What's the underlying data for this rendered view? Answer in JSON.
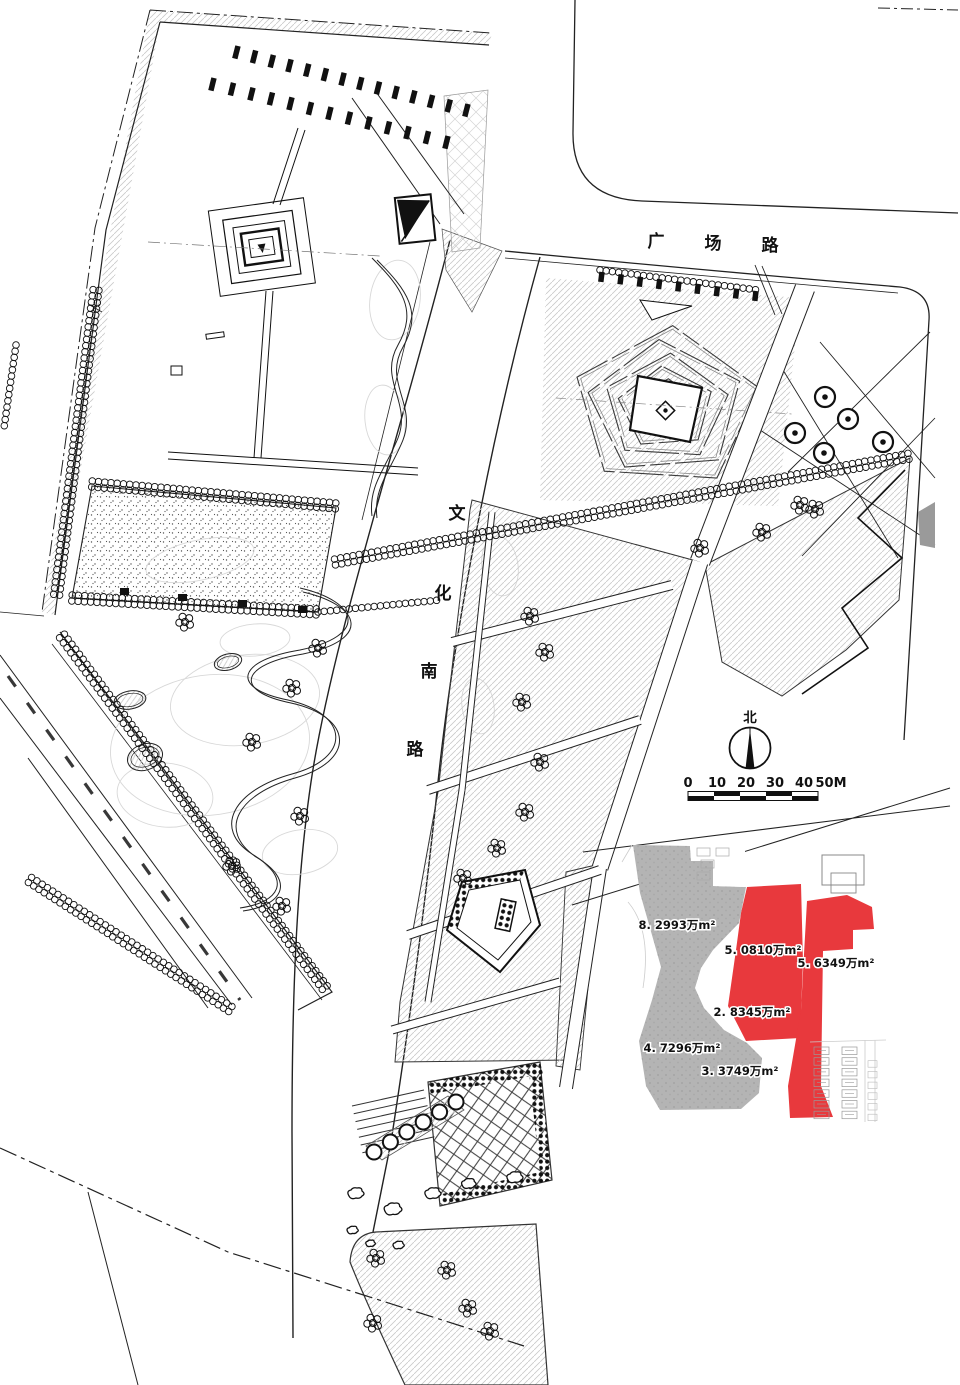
{
  "page": {
    "background": "#ffffff",
    "ink": "#1a1a1a"
  },
  "roads": {
    "horizontal": {
      "name": "广场路",
      "chars": [
        "广",
        "场",
        "路"
      ]
    },
    "vertical": {
      "name": "文化南路",
      "chars": [
        "文",
        "化",
        "南",
        "路"
      ]
    }
  },
  "compass": {
    "label": "北"
  },
  "scale_bar": {
    "ticks": [
      "0",
      "10",
      "20",
      "30",
      "40"
    ],
    "end_label": "50M"
  },
  "inset": {
    "colors": {
      "highlight": "#e8393d",
      "context": "#b4b4b4"
    },
    "areas": [
      {
        "label": "8. 2993万m²",
        "zone": "gray"
      },
      {
        "label": "5. 0810万m²",
        "zone": "red"
      },
      {
        "label": "5. 6349万m²",
        "zone": "red"
      },
      {
        "label": "2. 8345万m²",
        "zone": "red"
      },
      {
        "label": "4. 7296万m²",
        "zone": "gray"
      },
      {
        "label": "3. 3749万m²",
        "zone": "gray"
      }
    ]
  },
  "drawing": {
    "hatch": "#c9c9c9",
    "contour": "#d8d8d8"
  }
}
